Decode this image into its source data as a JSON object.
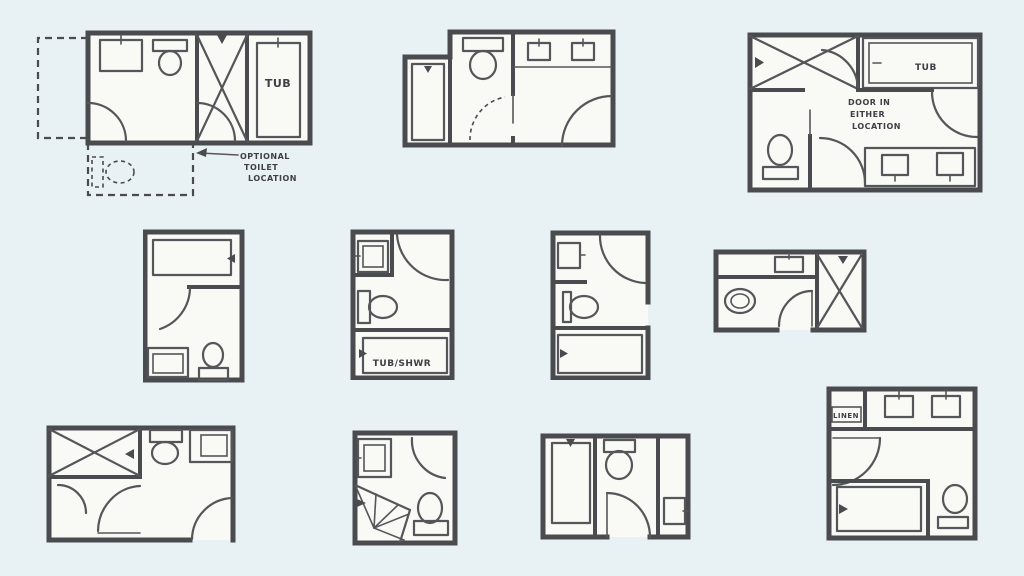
{
  "canvas": {
    "background": "#e8f1f3",
    "ink": "#4a4b4f",
    "ink_light": "#55565a",
    "paper": "#f9f9f6"
  },
  "labels": {
    "top_left_tub": "TUB",
    "top_left_note": [
      "OPTIONAL",
      "TOILET",
      "LOCATION"
    ],
    "top_right_tub": "TUB",
    "top_right_note": [
      "DOOR IN",
      "EITHER",
      "LOCATION"
    ],
    "mid_center_tub_shwr": "TUB/SHWR",
    "bottom_right_linen": "LINEN"
  }
}
